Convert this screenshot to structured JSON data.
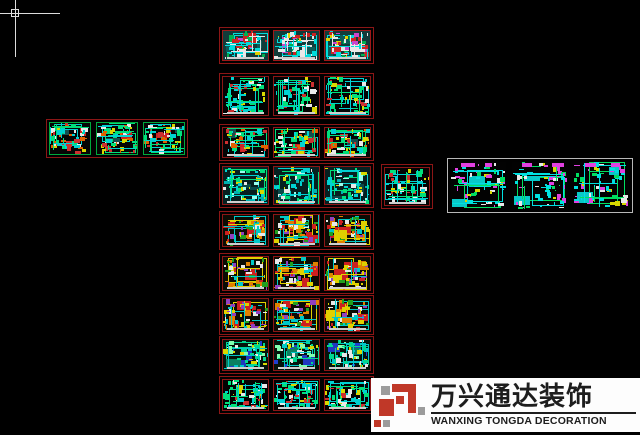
{
  "canvas": {
    "width": 640,
    "height": 435,
    "background": "#000000"
  },
  "cursor": {
    "x": 15,
    "y": 13,
    "h_len": 60,
    "v_len": 57,
    "pickbox": 8,
    "color": "#dcdcdc"
  },
  "watermark": {
    "brand_cn": "万兴通达装饰",
    "brand_en": "WANXING TONGDA DECORATION",
    "x": 371,
    "y": 378,
    "w": 269,
    "h": 54,
    "bg": "#fdfdfd",
    "text_color": "#1d1d1d",
    "logo_red": "#c03828",
    "logo_gray": "#9c9c9c"
  },
  "palettes": {
    "teal_sheet": {
      "bg": "#123c3a",
      "big": [
        [
          "#e8e8e8",
          3
        ],
        [
          "#0e5a58",
          2
        ],
        [
          "#cc2222",
          1
        ]
      ],
      "n": 46,
      "colors": [
        "#00dcdc",
        "#cc2222",
        "#e0d000",
        "#e8e8e8",
        "#00b050",
        "#cc44cc",
        "#00dcdc"
      ],
      "ln": 6,
      "lines": [
        "#00dcdc",
        "#e8e8e8"
      ]
    },
    "wire_green": {
      "bg": "#030303",
      "big": [],
      "n": 58,
      "colors": [
        "#00e07c",
        "#00d2d2",
        "#00e07c",
        "#00d2d2",
        "#e8e8e8",
        "#cc3030",
        "#d8d800"
      ],
      "ln": 9,
      "lines": [
        "#00e07c",
        "#00d2d2"
      ]
    },
    "wire_mixed": {
      "bg": "#050505",
      "big": [
        [
          "#164e4e",
          1
        ],
        [
          "#cc2222",
          1
        ]
      ],
      "n": 52,
      "colors": [
        "#00e07c",
        "#00d2d2",
        "#cc3030",
        "#e8e8e8",
        "#d8d800",
        "#00e07c",
        "#e06000"
      ],
      "ln": 7,
      "lines": [
        "#00e07c",
        "#00d2d2"
      ]
    },
    "dense_cyan": {
      "bg": "#062020",
      "big": [
        [
          "#0a4848",
          2
        ]
      ],
      "n": 62,
      "colors": [
        "#00d2d2",
        "#00e07c",
        "#00d2d2",
        "#99ffee",
        "#e8e8e8",
        "#00b0b0",
        "#d8d800"
      ],
      "ln": 8,
      "lines": [
        "#00d2d2",
        "#00e07c"
      ]
    },
    "colorful": {
      "bg": "#0c0c04",
      "big": [
        [
          "#e08000",
          2
        ],
        [
          "#cc2020",
          2
        ],
        [
          "#e0d000",
          1
        ]
      ],
      "n": 48,
      "colors": [
        "#e08000",
        "#cc2020",
        "#e0d000",
        "#00c8c8",
        "#20a020",
        "#9040c0",
        "#e8e8e8"
      ],
      "ln": 5,
      "lines": [
        "#00c8c8",
        "#e0d000"
      ]
    },
    "blue_green": {
      "bg": "#05140c",
      "big": [
        [
          "#2038c0",
          2
        ],
        [
          "#0a8060",
          1
        ]
      ],
      "n": 52,
      "colors": [
        "#00d890",
        "#00c8c8",
        "#2040d0",
        "#80ffb0",
        "#e8e8e8",
        "#00d890",
        "#d8d800"
      ],
      "ln": 7,
      "lines": [
        "#00d890",
        "#00c8c8"
      ]
    },
    "magenta_mix": {
      "bg": "#020202",
      "big": [
        [
          "#08c8c8",
          2
        ]
      ],
      "n": 56,
      "colors": [
        "#00e0e0",
        "#00e060",
        "#e040e0",
        "#e8e8e8",
        "#d8d800",
        "#00e0e0",
        "#e040e0"
      ],
      "ln": 6,
      "lines": [
        "#00e0e0",
        "#00e060"
      ]
    }
  },
  "groups": [
    {
      "name": "sheet-row-1",
      "x": 219,
      "y": 27,
      "w": 155,
      "h": 37,
      "border": "#8c1616",
      "pad": 2,
      "gap": 4,
      "palette": "teal_sheet",
      "frame": "#a01818",
      "bottombar": true,
      "seeds": [
        101,
        102,
        103
      ]
    },
    {
      "name": "sheet-row-2",
      "x": 219,
      "y": 73,
      "w": 155,
      "h": 46,
      "border": "#8c1616",
      "pad": 2,
      "gap": 4,
      "palette": "wire_green",
      "frame": "#8c1616",
      "bottombar": true,
      "seeds": [
        201,
        202,
        203
      ]
    },
    {
      "name": "sheet-row-3",
      "x": 219,
      "y": 124,
      "w": 155,
      "h": 37,
      "border": "#8c1616",
      "pad": 2,
      "gap": 4,
      "palette": "wire_mixed",
      "frame": "#8c1616",
      "bottombar": true,
      "seeds": [
        301,
        302,
        303
      ]
    },
    {
      "name": "sheet-row-4",
      "x": 219,
      "y": 163,
      "w": 155,
      "h": 45,
      "border": "#8c1616",
      "pad": 2,
      "gap": 4,
      "palette": "dense_cyan",
      "frame": "#8c1616",
      "bottombar": true,
      "seeds": [
        401,
        402,
        403
      ]
    },
    {
      "name": "sheet-row-5",
      "x": 219,
      "y": 211,
      "w": 155,
      "h": 39,
      "border": "#8c1616",
      "pad": 2,
      "gap": 4,
      "palette": "colorful",
      "frame": "#8c1616",
      "bottombar": true,
      "seeds": [
        501,
        502,
        503
      ]
    },
    {
      "name": "sheet-row-6",
      "x": 219,
      "y": 253,
      "w": 155,
      "h": 41,
      "border": "#8c1616",
      "pad": 2,
      "gap": 4,
      "palette": "colorful",
      "frame": "#8c1616",
      "bottombar": true,
      "seeds": [
        601,
        602,
        603
      ]
    },
    {
      "name": "sheet-row-7",
      "x": 219,
      "y": 295,
      "w": 155,
      "h": 40,
      "border": "#8c1616",
      "pad": 2,
      "gap": 4,
      "palette": "colorful",
      "frame": "#8c1616",
      "bottombar": true,
      "seeds": [
        701,
        702,
        703
      ]
    },
    {
      "name": "sheet-row-8",
      "x": 219,
      "y": 336,
      "w": 155,
      "h": 38,
      "border": "#8c1616",
      "pad": 2,
      "gap": 4,
      "palette": "blue_green",
      "frame": "#8c1616",
      "bottombar": true,
      "seeds": [
        801,
        802,
        803
      ]
    },
    {
      "name": "sheet-row-9",
      "x": 219,
      "y": 376,
      "w": 155,
      "h": 38,
      "border": "#8c1616",
      "pad": 2,
      "gap": 4,
      "palette": "wire_green",
      "frame": "#8c1616",
      "bottombar": true,
      "seeds": [
        901,
        902,
        903
      ]
    },
    {
      "name": "left-group",
      "x": 46,
      "y": 119,
      "w": 142,
      "h": 39,
      "border": "#8c1616",
      "pad": 2,
      "gap": 5,
      "palette": "wire_mixed",
      "frame": "#00a83c",
      "bottombar": false,
      "seeds": [
        151,
        152,
        153
      ]
    },
    {
      "name": "single-sheet",
      "x": 381,
      "y": 164,
      "w": 52,
      "h": 45,
      "border": "#8c1616",
      "pad": 2,
      "gap": 0,
      "palette": "wire_green",
      "frame": "#8c1616",
      "bottombar": true,
      "seeds": [
        171
      ]
    },
    {
      "name": "right-group",
      "x": 447,
      "y": 158,
      "w": 186,
      "h": 55,
      "border": "#b8b8b8",
      "pad": 3,
      "gap": 6,
      "palette": "magenta_mix",
      "frame": "none",
      "bottombar": false,
      "toplabels": "#e040e0",
      "seeds": [
        181,
        182,
        183
      ]
    }
  ]
}
